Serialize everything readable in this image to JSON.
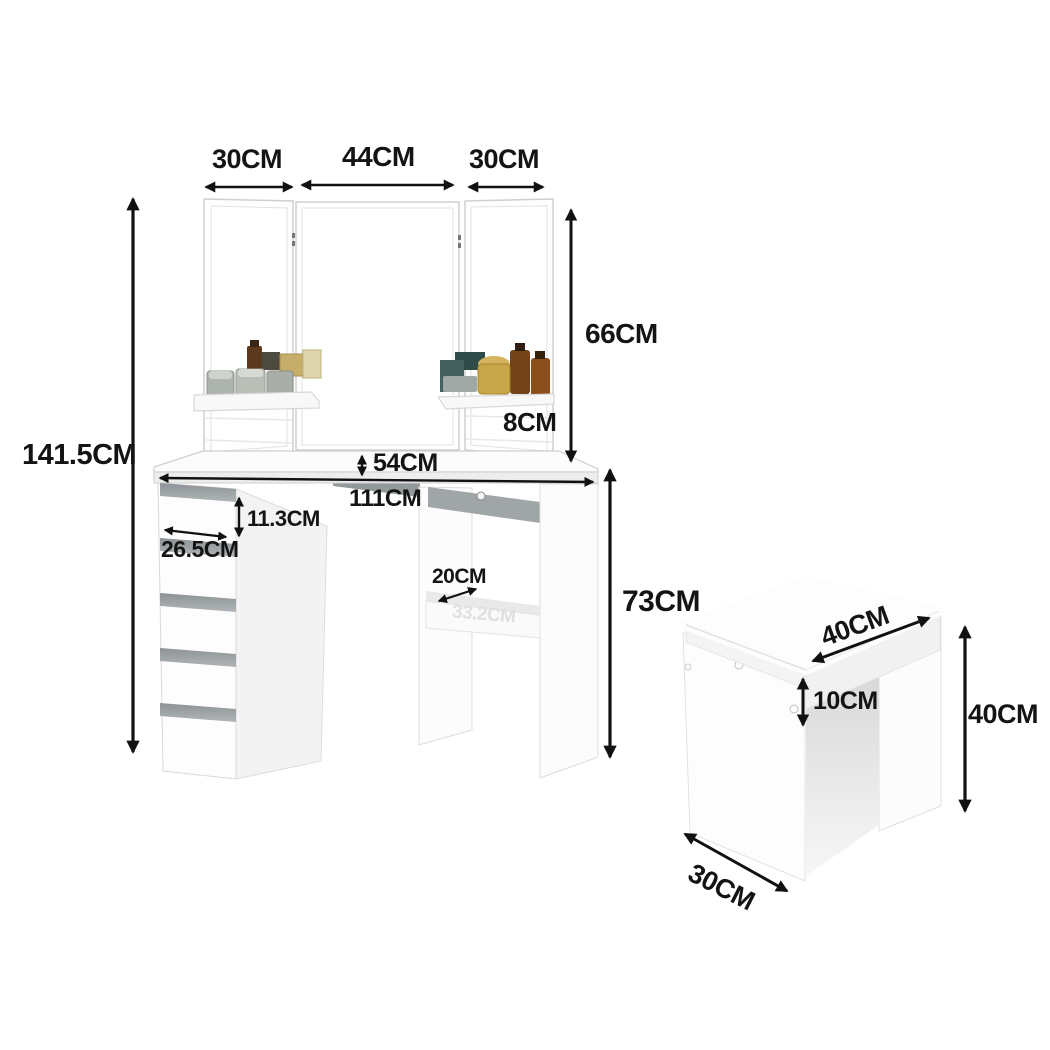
{
  "image": {
    "kind": "product dimension diagram",
    "subject": "corner dressing table with tri-fold mirror, five drawers and cushioned stool",
    "unit": "CM"
  },
  "labels": {
    "mirror_left_width": "30CM",
    "mirror_center_width": "44CM",
    "mirror_right_width": "30CM",
    "mirror_height": "66CM",
    "shelf_depth": "8CM",
    "total_height": "141.5CM",
    "desk_depth": "54CM",
    "desk_width": "111CM",
    "drawer_height": "11.3CM",
    "drawer_width": "26.5CM",
    "leg_shelf_depth": "20CM",
    "desk_height": "73CM",
    "stool_seat_width": "40CM",
    "stool_cushion_height": "10CM",
    "stool_height": "40CM",
    "stool_depth": "30CM",
    "shelf_watermark": "33.2CM"
  },
  "colors": {
    "background": "#ffffff",
    "dimension_text": "#141414",
    "arrow": "#111111",
    "furniture_fill": "#fdfdfd",
    "furniture_edge": "#d6d6d6",
    "drawer_handle": "#9aa0a3"
  }
}
